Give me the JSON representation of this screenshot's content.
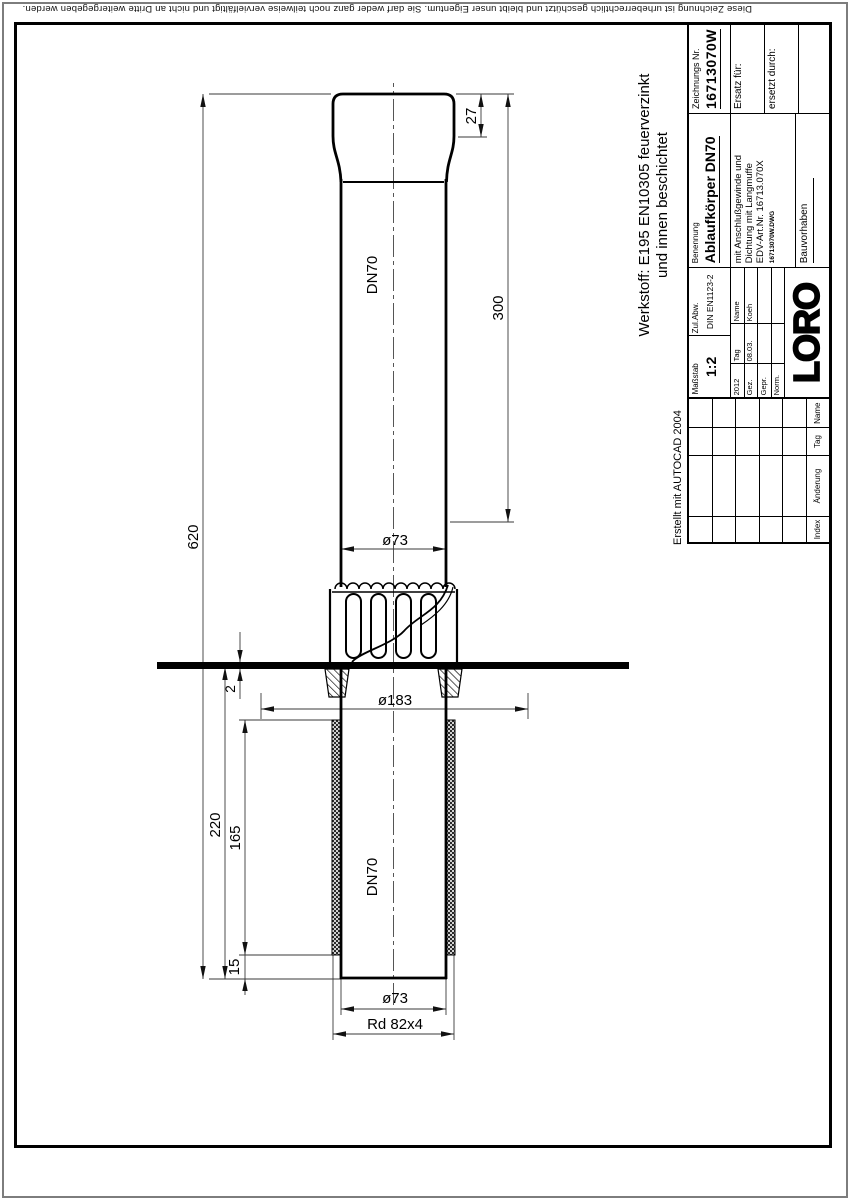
{
  "meta": {
    "copyright": "Diese Zeichnung ist urheberrechtlich geschützt und bleibt unser Eigentum. Sie darf weder ganz noch teilweise vervielfältigt und nicht an Dritte weitergegeben werden.",
    "created_with": "Erstellt mit AUTOCAD 2004"
  },
  "material_note": {
    "line1": "Werkstoff:  E195 EN10305 feuerverzinkt",
    "line2": "und innen beschichtet"
  },
  "drawing": {
    "type": "technical drawing, roof drain body with pipe, section view",
    "dim_overall_length": "620",
    "dim_upper_length": "300",
    "dim_socket_length": "27",
    "dim_upper_diameter": "ø73",
    "dim_flange_diameter": "ø183",
    "dim_plate_thickness": "2",
    "dim_lower_length": "220",
    "dim_thread_length": "165",
    "dim_end_offset": "15",
    "dim_lower_diameter": "ø73",
    "dim_thread": "Rd  82x4",
    "label_nominal_upper": "DN70",
    "label_nominal_lower": "DN70"
  },
  "title_block": {
    "massstab_label": "Maßstab",
    "massstab": "1:2",
    "zul_abw_label": "Zul.Abw.",
    "zul_abw": "DIN EN1123-2",
    "signoff": {
      "year": "2012",
      "tag_header": "Tag",
      "name_header": "Name",
      "rows": [
        {
          "label": "Gez.",
          "tag": "08.03.",
          "name": "Koeh"
        },
        {
          "label": "Gepr.",
          "tag": "",
          "name": ""
        },
        {
          "label": "Norm.",
          "tag": "",
          "name": ""
        }
      ]
    },
    "benennung_label": "Benennung",
    "benennung": "Ablaufkörper DN70",
    "desc_line1": "mit Anschlußgewinde und",
    "desc_line2": "Dichtung mit Langmuffe",
    "desc_line3": "EDV-Art.Nr. 16713.070X",
    "dwg_file": "16713070W.DWG",
    "bauvorhaben_label": "Bauvorhaben",
    "zeichnungs_nr_label": "Zeichnungs Nr.",
    "zeichnungs_nr": "16713070W",
    "ersatz_fuer_label": "Ersatz für:",
    "ersetzt_durch_label": "ersetzt durch:",
    "logo": "LORO",
    "revision_headers": [
      "Index",
      "Änderung",
      "Tag",
      "Name"
    ]
  },
  "colors": {
    "line": "#000000",
    "thin_line": "#3a3a3a",
    "frame_outer": "#7d7d7d",
    "background": "#ffffff"
  }
}
